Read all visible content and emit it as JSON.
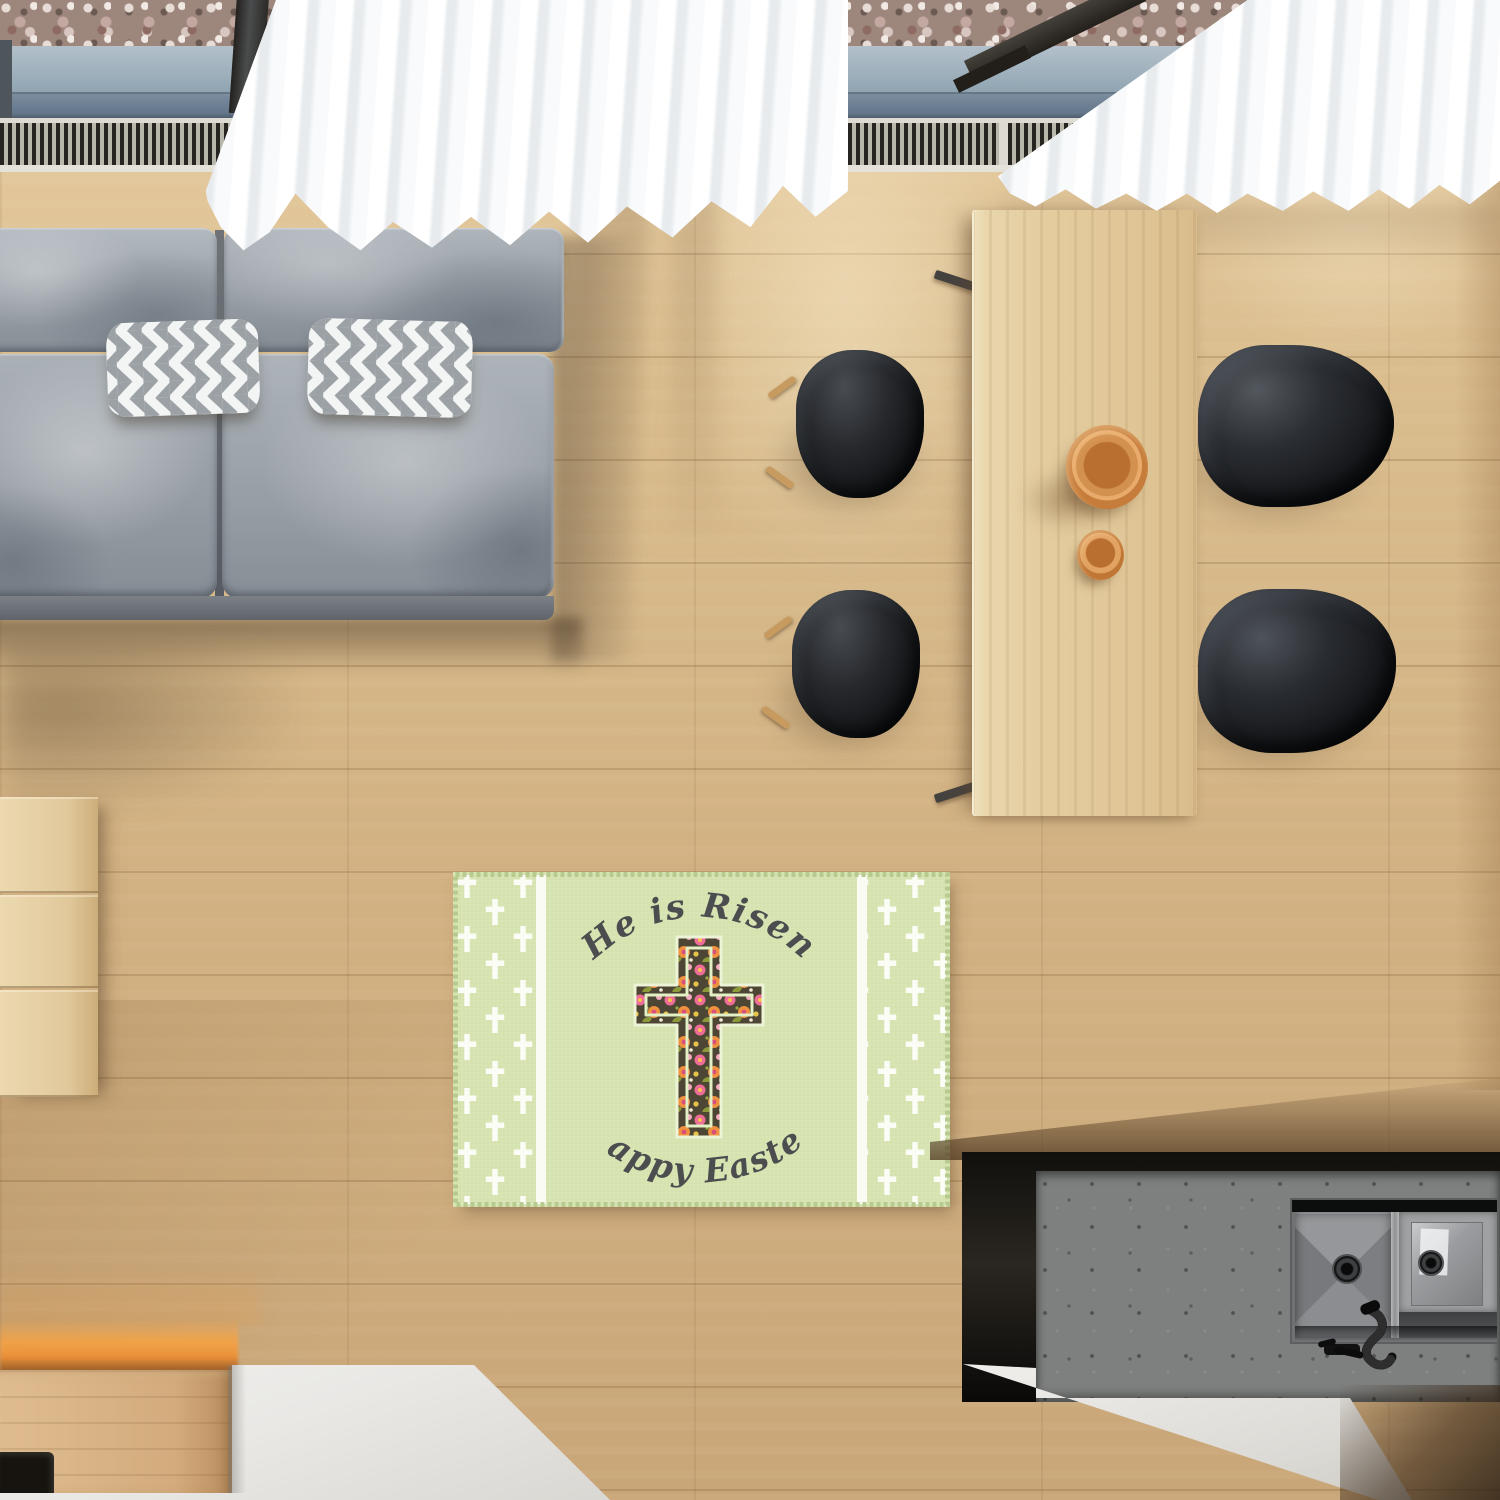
{
  "rug": {
    "text_top": "He is Risen",
    "text_bottom": "Happy Easter",
    "colors": {
      "base": "#d7e4b2",
      "stripe_white": "#fbfdf6",
      "cross_white": "#fbfdf6",
      "border_stitch": "#b7cb90",
      "text": "#4b4d4f",
      "floral_background": "#4e4634",
      "floral_pink": "#ee6d98",
      "floral_orange": "#f0913e",
      "floral_leaf": "#8d9a3c",
      "inner_outline": "#e3efc4"
    }
  },
  "palette": {
    "floor": "#d2b283",
    "floor_sunlit": "#eedcb4",
    "sofa_gray": "#9aa1a8",
    "pillow_chevron_gray": "#9ba1a5",
    "curtain_white": "#fafbfc",
    "table_wood": "#e4cda0",
    "chair_black": "#141619",
    "chair_leg_wood": "#c79a5f",
    "bowl_copper": "#c9803d",
    "gravel": "#cbb7ae",
    "window_sill_blue_gray": "#8ea3b0",
    "radiator_slat": "#26251f",
    "sideboard_wood": "#e2cda4",
    "counter_white": "#eceae6",
    "concrete": "#7e807f",
    "kitchen_cabinet_black": "#14120e",
    "under_cabinet_glow": "#f2a14b",
    "sink_steel": "#8f9193"
  }
}
